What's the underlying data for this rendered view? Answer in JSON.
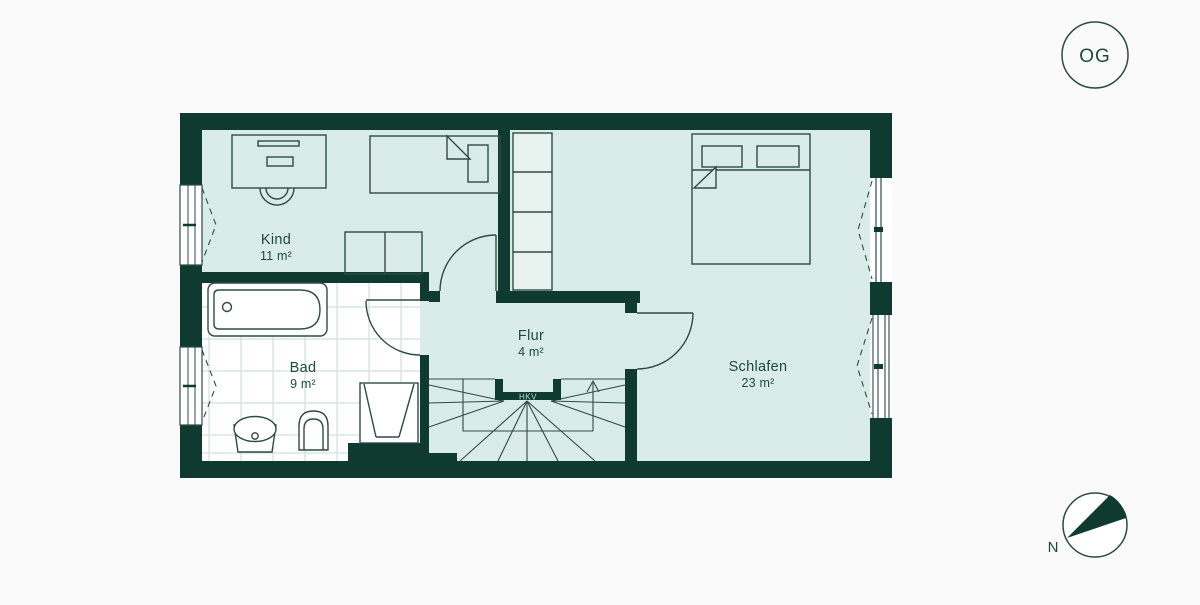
{
  "floor_badge": {
    "label": "OG"
  },
  "compass": {
    "label": "N"
  },
  "rooms": [
    {
      "name": "Kind",
      "area": "11 m²"
    },
    {
      "name": "Bad",
      "area": "9 m²"
    },
    {
      "name": "Flur",
      "area": "4 m²"
    },
    {
      "name": "Schlafen",
      "area": "23 m²"
    }
  ],
  "equipment": {
    "hkv_label": "HKV"
  },
  "colors": {
    "wall": "#0f3a2f",
    "room_fill": "#daece7",
    "bath_fill": "#ffffff",
    "tile_line": "#c7d9d2",
    "outline": "#2c4c42",
    "text": "#1d4a3d",
    "background": "#fafafa"
  }
}
